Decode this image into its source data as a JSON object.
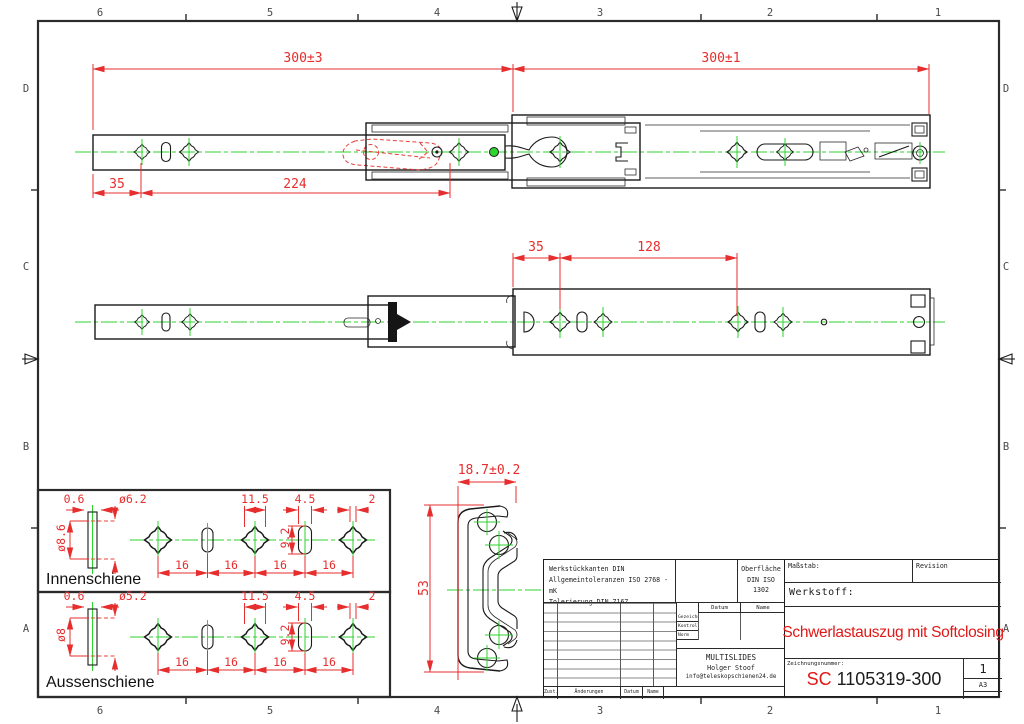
{
  "zones": {
    "cols": [
      "6",
      "5",
      "4",
      "3",
      "2",
      "1"
    ],
    "rows": [
      "D",
      "C",
      "B",
      "A"
    ]
  },
  "views": {
    "top": {
      "len_inner": "300±3",
      "len_outer": "300±1",
      "offset": "35",
      "span": "224"
    },
    "front": {
      "offset": "35",
      "span": "128"
    },
    "section": {
      "width": "18.7±0.2",
      "height": "53"
    },
    "inner_detail": {
      "label": "Innenschiene",
      "thickness": "0.6",
      "hole_small": "ø6.2",
      "hole_big": "ø8.6",
      "cross": "11.5",
      "slot_w": "4.5",
      "slot_h": "9.2",
      "tip": "2",
      "p1": "16",
      "p2": "16",
      "p3": "16",
      "p4": "16"
    },
    "outer_detail": {
      "label": "Aussenschiene",
      "thickness": "0.6",
      "hole_small": "ø5.2",
      "hole_big": "ø8",
      "cross": "11.5",
      "slot_w": "4.5",
      "slot_h": "9.2",
      "tip": "2",
      "p1": "16",
      "p2": "16",
      "p3": "16",
      "p4": "16"
    }
  },
  "title_block": {
    "tol1": "Werkstückkanten DIN",
    "tol2": "Allgemeintoleranzen ISO 2768 - mK",
    "tol3": "Tolerierung DIN 7167",
    "surface1": "Oberfläche",
    "surface2": "DIN ISO",
    "surface3": "1302",
    "scale_label": "Maßstab:",
    "revision_label": "Revision",
    "material_label": "Werkstoff:",
    "title": "Schwerlastauszug mit Softclosing",
    "number_label": "Zeichnungsnummer:",
    "number_prefix": "SC",
    "number": " 1105319-300",
    "sheet": "1",
    "format": "A3",
    "company": "MULTISLIDES",
    "author": "Holger Stoof",
    "email": "info@teleskopschienen24.de",
    "col_datum": "Datum",
    "col_name": "Name",
    "row_drawn": "Gezeichnet",
    "row_checked": "Kontrolliert",
    "row_norm": "Norm",
    "foot_zust": "Zust.",
    "foot_aend": "Änderungen",
    "foot_datum": "Datum",
    "foot_name": "Name"
  },
  "colors": {
    "dimension": "#e62e2e",
    "centerline": "#2fd32f",
    "line": "#1a1a1a",
    "title_red": "#e01818"
  }
}
